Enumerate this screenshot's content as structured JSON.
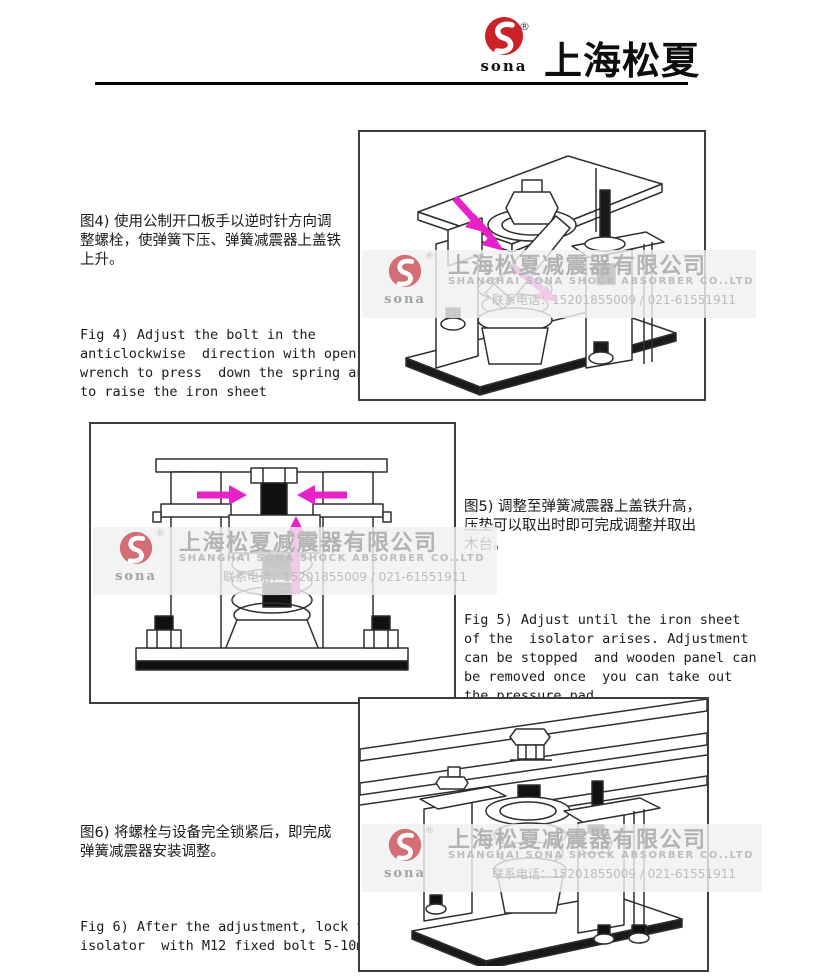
{
  "header": {
    "logo_text": "sona",
    "registered_mark": "®",
    "brand_cn": "上海松夏"
  },
  "watermark": {
    "logo_text": "sona",
    "registered_mark": "®",
    "company_cn": "上海松夏减震器有限公司",
    "company_en": "SHANGHAI SONA SHOCK ABSORBER CO..LTD",
    "contact": "联系电话：15201855009 / 021-61551911"
  },
  "sections": [
    {
      "figure": "Fig 4",
      "cn": "图4) 使用公制开口板手以逆时针方向调\n整螺栓，使弹簧下压、弹簧减震器上盖铁\n上升。",
      "en": "Fig 4) Adjust the bolt in the\nanticlockwise  direction with open\nwrench to press  down the spring and\nto raise the iron sheet"
    },
    {
      "figure": "Fig 5",
      "cn": "图5) 调整至弹簧减震器上盖铁升高，\n压垫可以取出时即可完成调整并取出\n木台。",
      "en": "Fig 5) Adjust until the iron sheet\nof the  isolator arises. Adjustment\ncan be stopped  and wooden panel can\nbe removed once  you can take out\nthe pressure pad."
    },
    {
      "figure": "Fig 6",
      "cn": "图6) 将螺栓与设备完全锁紧后，即完成\n弹簧减震器安装调整。",
      "en": "Fig 6) After the adjustment, lock the\nisolator  with M12 fixed bolt 5-10mm"
    }
  ],
  "colors": {
    "brand_red": "#cc2127",
    "arrow_magenta": "#e722c9",
    "watermark_gray": "#b5b5b5"
  }
}
